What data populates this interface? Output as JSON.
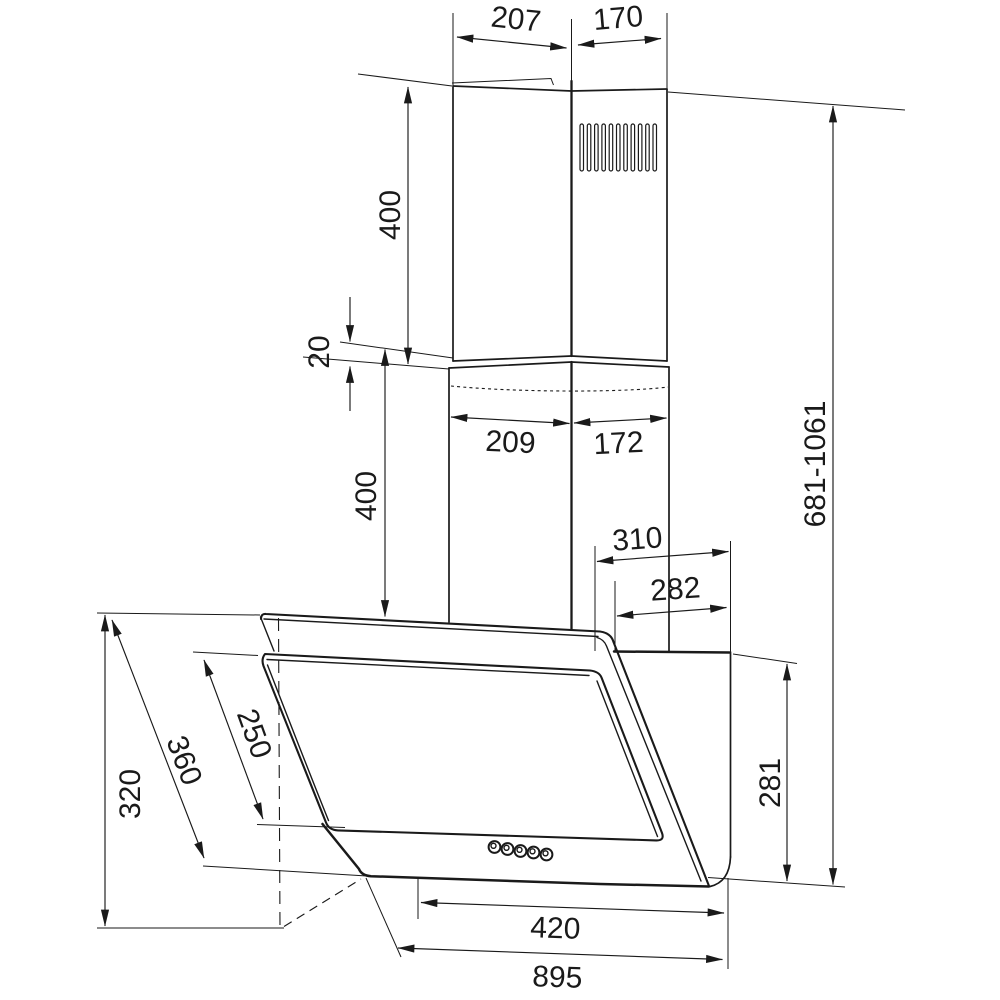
{
  "drawing": {
    "title": "cooker hood dimensional drawing",
    "dims": {
      "chimney_top_front_width": "207",
      "chimney_top_side_depth": "170",
      "upper_chimney_height": "400",
      "chimney_overlap": "20",
      "lower_chimney_height": "400",
      "chimney_bottom_front_width": "209",
      "chimney_bottom_side_depth": "172",
      "overall_height_range": "681-1061",
      "hood_top_depth": "310",
      "hood_body_depth": "282",
      "hood_rear_height": "281",
      "hood_front_height": "320",
      "glass_panel_slant_length": "360",
      "front_glass_slant_length": "250",
      "bottom_opening_width": "420",
      "overall_width": "895"
    }
  }
}
